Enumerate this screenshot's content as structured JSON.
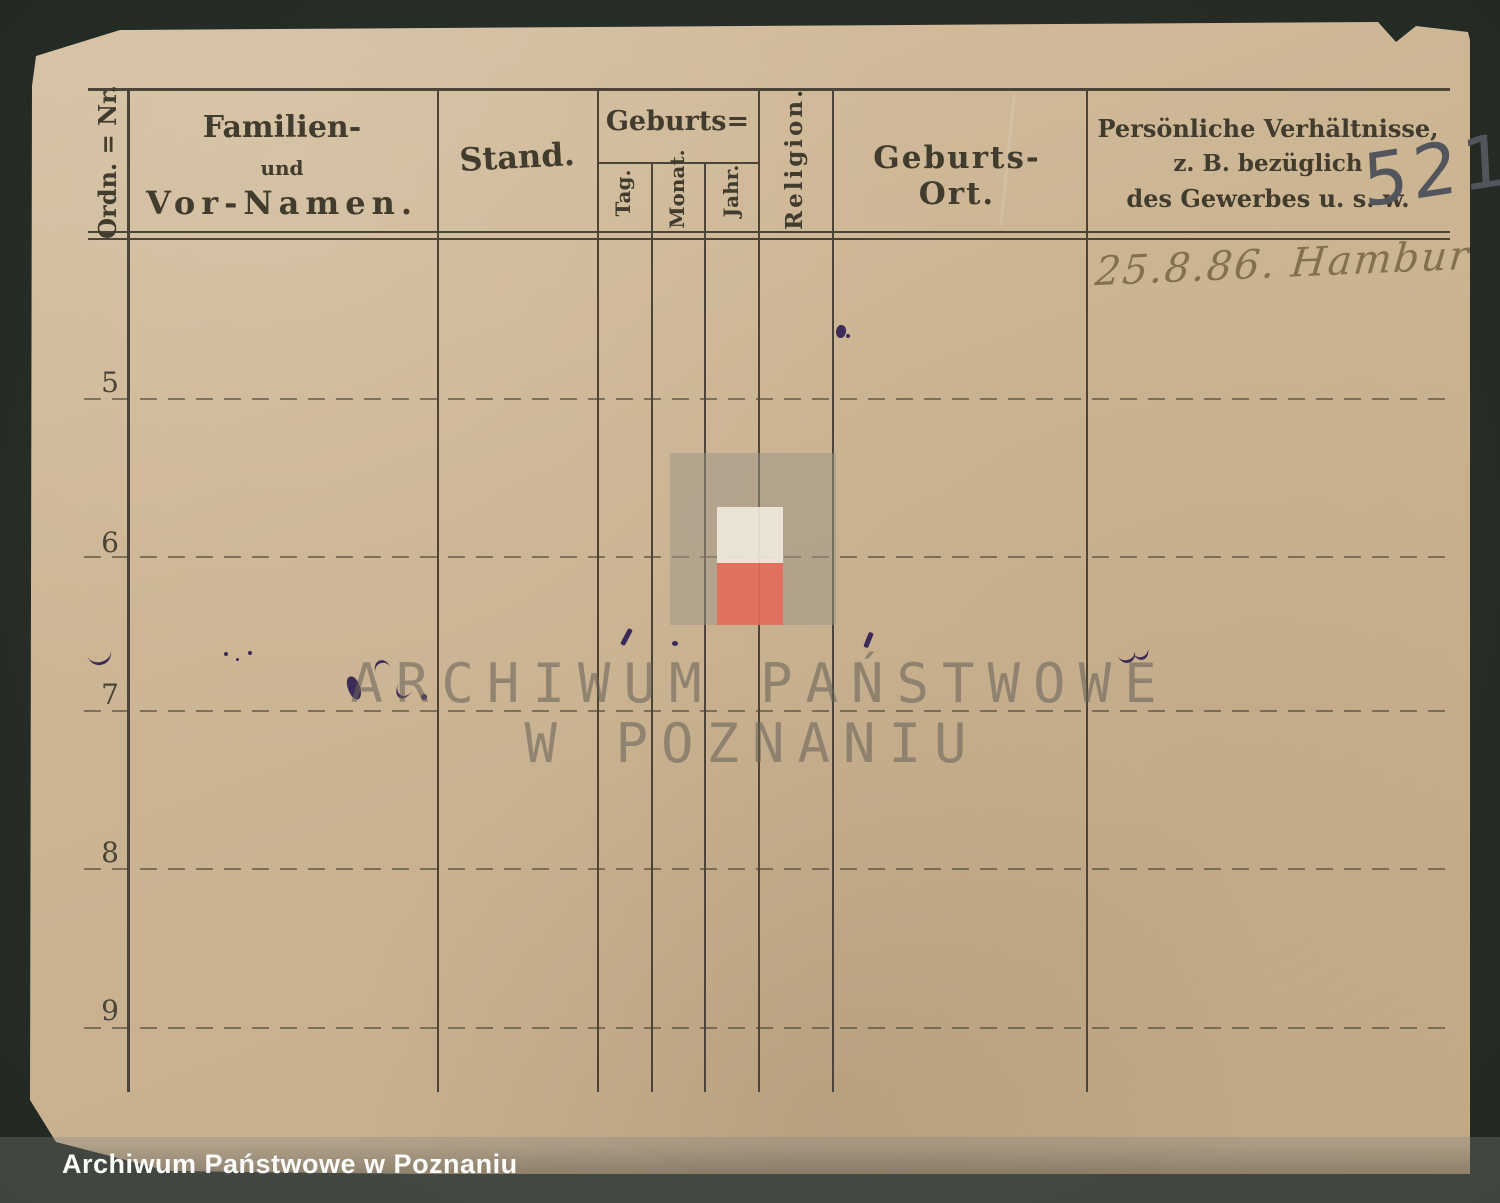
{
  "card": {
    "number_annotation": "521",
    "entry_note": "25.8.86. Hamburg.",
    "headers": {
      "ordnr": "Ordn. = Nr.",
      "familien_1": "Familien-",
      "familien_2": "und",
      "familien_3": "Vor-Namen.",
      "stand": "Stand.",
      "geburts": "Geburts=",
      "tag": "Tag.",
      "monat": "Monat.",
      "jahr": "Jahr.",
      "religion": "Religion.",
      "geburtsort": "Geburts-Ort.",
      "pers_1": "Persönliche Verhältnisse,",
      "pers_2": "z. B. bezüglich",
      "pers_3": "des Gewerbes u. s. w."
    },
    "row_numbers": [
      "5",
      "6",
      "7",
      "8",
      "9"
    ]
  },
  "watermark": {
    "line1": "ARCHIWUM PAŃSTWOWE",
    "line2": "W POZNANIU"
  },
  "archive_bar": {
    "label": "Archiwum Państwowe w Poznaniu"
  },
  "colors": {
    "background": "#272e27",
    "paper": "#ccb593",
    "rule": "#4c4537",
    "logo_gray": "#a49d8f",
    "logo_white": "#f1ebdf",
    "logo_red": "#ea6e5e",
    "ink_purple": "#3c2a58",
    "pencil": "#53555c",
    "handwriting_ink": "#84704f",
    "bar_text": "#fbfbf9"
  }
}
